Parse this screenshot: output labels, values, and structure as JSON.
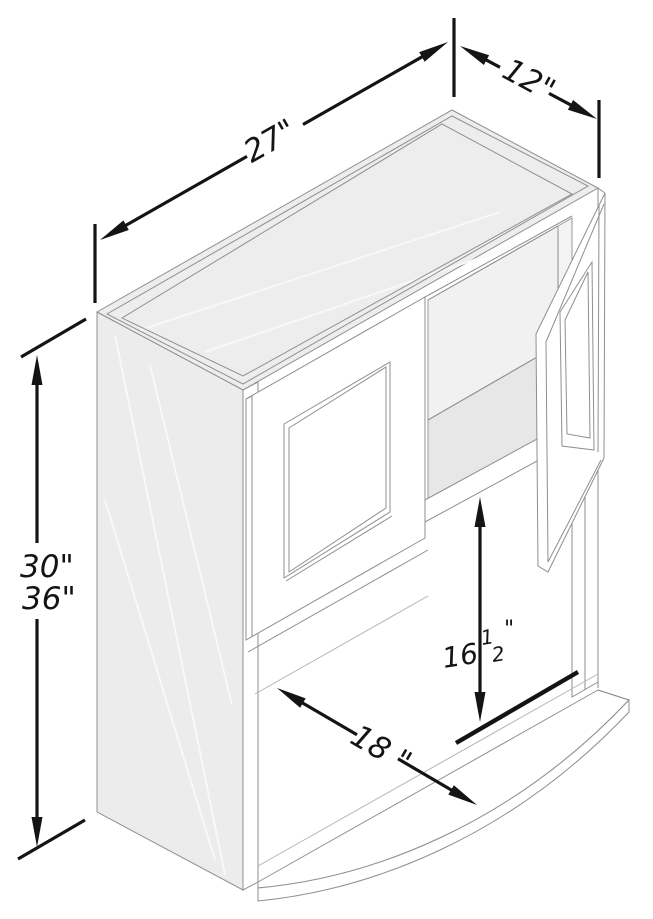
{
  "figure": {
    "kind": "isometric-line-drawing",
    "subject": "wall microwave cabinet, two framed doors, right door open, open lower shelf with curved front"
  },
  "dimensions": {
    "width_label": "27\"",
    "depth_label": "12\"",
    "height_label_a": "30\"",
    "height_label_b": "36\"",
    "opening_height_whole": "16",
    "opening_height_numerator": "1",
    "opening_height_denominator": "2",
    "opening_height_unit": "\"",
    "opening_width_label": "18 \""
  },
  "colors": {
    "dimension_ink": "#141414",
    "drawing_line": "#8f8f8f",
    "panel_fill": "#ececec",
    "top_fill": "#ededed",
    "interior_back_fill": "#f1f1f1",
    "interior_floor_fill": "#e7e7e7",
    "background": "#ffffff"
  }
}
